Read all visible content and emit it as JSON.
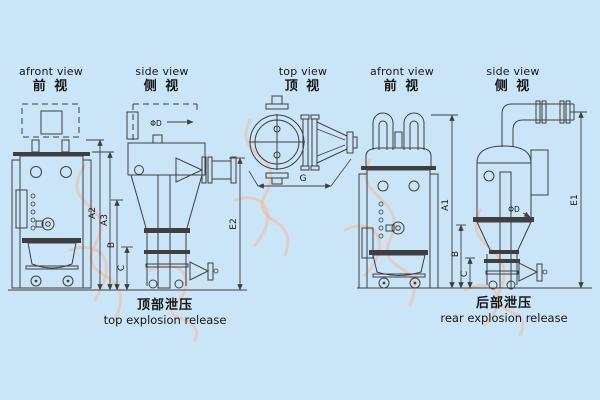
{
  "colors": {
    "background": "#cbe5f8",
    "line": "#3f3f3f",
    "text": "#161616",
    "watermark": "#eebda3"
  },
  "views": [
    {
      "en": "afront view",
      "zh": "前 视"
    },
    {
      "en": "side view",
      "zh": "侧 视"
    },
    {
      "en": "top view",
      "zh": "顶 视"
    },
    {
      "en": "afront view",
      "zh": "前 视"
    },
    {
      "en": "side view",
      "zh": "侧 视"
    }
  ],
  "captions": {
    "left": {
      "zh": "顶部泄压",
      "en": "top explosion release"
    },
    "right": {
      "zh": "后部泄压",
      "en": "rear explosion release"
    }
  },
  "dims": {
    "a2": "A2",
    "a3": "A3",
    "b_left": "B",
    "c_left": "C",
    "e2": "E2",
    "phi_d_side": "ΦD",
    "g": "G",
    "a1": "A1",
    "b_right": "B",
    "c_right": "C",
    "e1": "E1",
    "phi_d_rear": "ΦD"
  }
}
